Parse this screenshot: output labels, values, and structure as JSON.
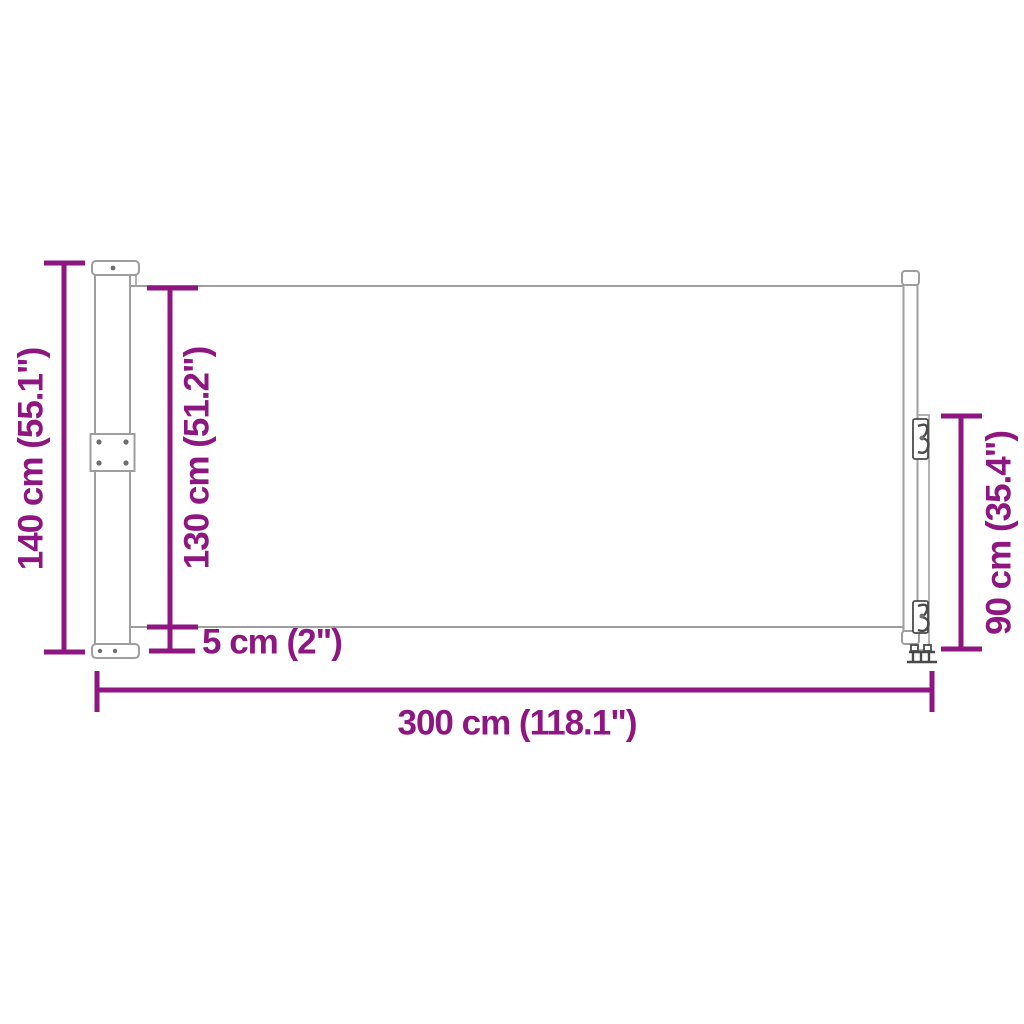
{
  "style": {
    "accent_color": "#8E1680",
    "drawing_line_color": "#9e9e9e",
    "hardware_detail_color": "#4a4a4a",
    "background_color": "#ffffff"
  },
  "figure": {
    "kind": "product-dimension-line-drawing",
    "units_shown": [
      "cm",
      "in"
    ]
  },
  "dimensions": {
    "total_height": {
      "label": "140 cm (55.1\")"
    },
    "fabric_height": {
      "label": "130 cm (51.2\")"
    },
    "bottom_gap": {
      "label": "5 cm (2\")"
    },
    "total_width": {
      "label": "300 cm (118.1\")"
    },
    "pole_height": {
      "label": "90 cm (35.4\")"
    }
  }
}
